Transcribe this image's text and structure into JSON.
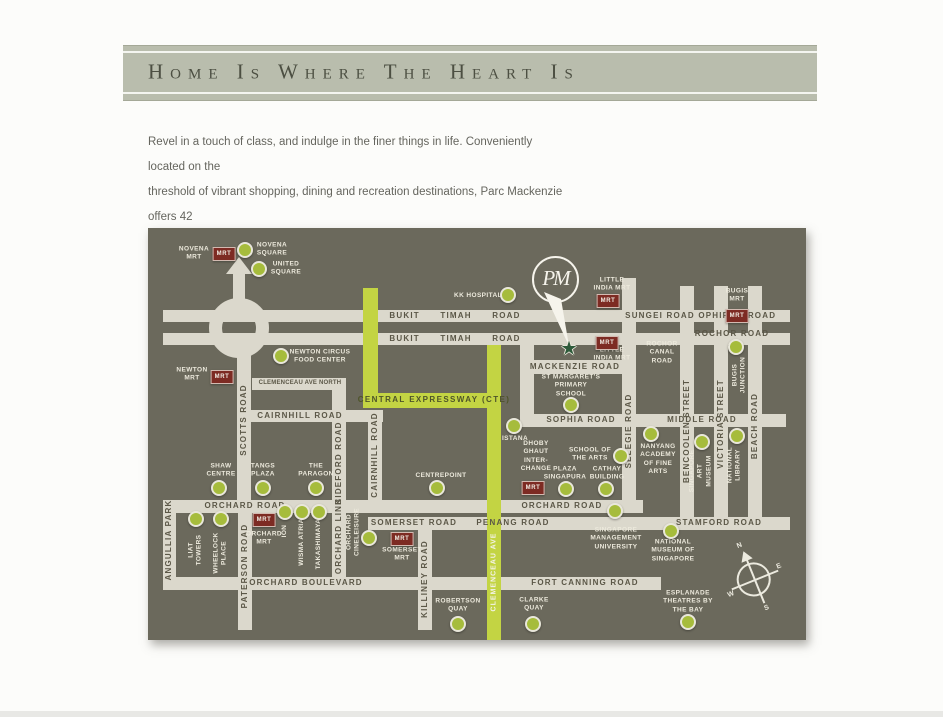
{
  "banner": {
    "title": "Home Is Where The Heart Is"
  },
  "intro": {
    "text": "Revel in a touch of class, and indulge in the finer things in life. Conveniently located on the\nthreshold of vibrant shopping, dining and recreation destinations, Parc Mackenzie offers 42\nunits of freehold contemporary residential living."
  },
  "map": {
    "bg_color": "#6b695c",
    "road_color": "#dbd8cc",
    "expressway_color": "#c3d443",
    "dot_color": "#a6bc3c",
    "mrt_color": "#7d2b23",
    "mrt_label": "MRT",
    "landmark": {
      "monogram": "PM",
      "star_icon": "★"
    },
    "compass": {
      "n": "N",
      "e": "E",
      "s": "S",
      "w": "W"
    },
    "roads": [
      {
        "n": "bukit-timah-sungei-ophir-road",
        "x": 15,
        "y": 82,
        "w": 627,
        "h": 12
      },
      {
        "n": "bukit-timah-rochor-road",
        "x": 15,
        "y": 105,
        "w": 627,
        "h": 12
      },
      {
        "n": "clemenceau-ave-north",
        "x": 104,
        "y": 150,
        "w": 94,
        "h": 12
      },
      {
        "n": "cairnhill-road-h",
        "x": 95,
        "y": 182,
        "w": 140,
        "h": 12
      },
      {
        "n": "mackenzie-west-link",
        "x": 372,
        "y": 117,
        "w": 14,
        "h": 82
      },
      {
        "n": "mackenzie-road",
        "x": 372,
        "y": 132,
        "w": 108,
        "h": 14
      },
      {
        "n": "sophia-middle-road",
        "x": 372,
        "y": 186,
        "w": 266,
        "h": 13
      },
      {
        "n": "selegie-road",
        "x": 474,
        "y": 50,
        "w": 14,
        "h": 222
      },
      {
        "n": "bencoolen-street",
        "x": 532,
        "y": 58,
        "w": 14,
        "h": 231
      },
      {
        "n": "victoria-street",
        "x": 566,
        "y": 58,
        "w": 14,
        "h": 231
      },
      {
        "n": "beach-road",
        "x": 600,
        "y": 58,
        "w": 14,
        "h": 231
      },
      {
        "n": "orchard-road",
        "x": 15,
        "y": 272,
        "w": 480,
        "h": 13
      },
      {
        "n": "somerset-penang-stamford-road",
        "x": 220,
        "y": 289,
        "w": 422,
        "h": 13
      },
      {
        "n": "orchard-blvd-fort-canning-road",
        "x": 15,
        "y": 349,
        "w": 498,
        "h": 13
      },
      {
        "n": "angullia-park",
        "x": 15,
        "y": 285,
        "w": 13,
        "h": 64
      },
      {
        "n": "paterson-road",
        "x": 90,
        "y": 285,
        "w": 14,
        "h": 117
      },
      {
        "n": "scotts-road",
        "x": 89,
        "y": 125,
        "w": 14,
        "h": 147
      },
      {
        "n": "bideford-road",
        "x": 184,
        "y": 162,
        "w": 14,
        "h": 110
      },
      {
        "n": "cairnhill-road-v",
        "x": 220,
        "y": 194,
        "w": 14,
        "h": 78
      },
      {
        "n": "orchard-link",
        "x": 184,
        "y": 285,
        "w": 14,
        "h": 64
      },
      {
        "n": "killiney-road",
        "x": 270,
        "y": 302,
        "w": 14,
        "h": 100
      },
      {
        "n": "central-expressway-vertical",
        "x": 215,
        "y": 60,
        "w": 15,
        "h": 120,
        "c": 1
      },
      {
        "n": "central-expressway-horizontal",
        "x": 215,
        "y": 165,
        "w": 138,
        "h": 15,
        "c": 1
      },
      {
        "n": "clemenceau-ave",
        "x": 339,
        "y": 117,
        "w": 14,
        "h": 295,
        "c": 1
      }
    ],
    "labels": [
      {
        "t": "BUKIT      TIMAH      ROAD",
        "x": 307,
        "y": 88,
        "k": "road"
      },
      {
        "t": "BUKIT      TIMAH      ROAD",
        "x": 307,
        "y": 111,
        "k": "road"
      },
      {
        "t": "SUNGEI ROAD",
        "x": 512,
        "y": 88,
        "k": "road"
      },
      {
        "t": "OPHIR",
        "x": 566,
        "y": 88,
        "k": "road"
      },
      {
        "t": "ROAD",
        "x": 614,
        "y": 88,
        "k": "road"
      },
      {
        "t": "ROCHOR ROAD",
        "x": 584,
        "y": 106,
        "k": "road"
      },
      {
        "t": "CLEMENCEAU AVE NORTH",
        "x": 152,
        "y": 156,
        "k": "roadsm"
      },
      {
        "t": "CAIRNHILL ROAD",
        "x": 152,
        "y": 188,
        "k": "road"
      },
      {
        "t": "MACKENZIE ROAD",
        "x": 427,
        "y": 139,
        "k": "road"
      },
      {
        "t": "SOPHIA ROAD",
        "x": 433,
        "y": 192,
        "k": "road"
      },
      {
        "t": "MIDDLE ROAD",
        "x": 554,
        "y": 192,
        "k": "road"
      },
      {
        "t": "ORCHARD ROAD",
        "x": 97,
        "y": 278,
        "k": "road"
      },
      {
        "t": "ORCHARD ROAD",
        "x": 414,
        "y": 278,
        "k": "road"
      },
      {
        "t": "SOMERSET ROAD",
        "x": 266,
        "y": 295,
        "k": "road"
      },
      {
        "t": "PENANG ROAD",
        "x": 365,
        "y": 295,
        "k": "road"
      },
      {
        "t": "STAMFORD ROAD",
        "x": 571,
        "y": 295,
        "k": "road"
      },
      {
        "t": "ORCHARD BOULEVARD",
        "x": 158,
        "y": 355,
        "k": "road"
      },
      {
        "t": "FORT CANNING ROAD",
        "x": 437,
        "y": 355,
        "k": "road"
      },
      {
        "t": "SCOTTS ROAD",
        "x": 96,
        "y": 192,
        "k": "road",
        "v": 1
      },
      {
        "t": "ANGULLIA PARK",
        "x": 21,
        "y": 312,
        "k": "road",
        "v": 1
      },
      {
        "t": "PATERSON ROAD",
        "x": 97,
        "y": 338,
        "k": "road",
        "v": 1
      },
      {
        "t": "BIDEFORD ROAD",
        "x": 191,
        "y": 235,
        "k": "road",
        "v": 1
      },
      {
        "t": "CAIRNHILL ROAD",
        "x": 227,
        "y": 227,
        "k": "road",
        "v": 1
      },
      {
        "t": "ORCHARD LINK",
        "x": 191,
        "y": 308,
        "k": "road",
        "v": 1
      },
      {
        "t": "KILLINEY ROAD",
        "x": 277,
        "y": 351,
        "k": "road",
        "v": 1
      },
      {
        "t": "SELEGIE ROAD",
        "x": 481,
        "y": 203,
        "k": "road",
        "v": 1
      },
      {
        "t": "BENCOOLEN STREET",
        "x": 539,
        "y": 203,
        "k": "road",
        "v": 1
      },
      {
        "t": "VICTORIA STREET",
        "x": 573,
        "y": 196,
        "k": "road",
        "v": 1
      },
      {
        "t": "BEACH ROAD",
        "x": 607,
        "y": 198,
        "k": "road",
        "v": 1
      },
      {
        "t": "CENTRAL EXPRESSWAY (CTE)",
        "x": 286,
        "y": 172,
        "k": "lime"
      },
      {
        "t": "CLEMENCEAU AVE",
        "x": 346,
        "y": 344,
        "k": "limew",
        "v": 1
      },
      {
        "t": "NOVENA\nMRT",
        "x": 46,
        "y": 26,
        "k": "poi"
      },
      {
        "t": "NOVENA\nSQUARE",
        "x": 124,
        "y": 22,
        "k": "poi"
      },
      {
        "t": "UNITED\nSQUARE",
        "x": 138,
        "y": 41,
        "k": "poi"
      },
      {
        "t": "NEWTON\nMRT",
        "x": 44,
        "y": 147,
        "k": "poi"
      },
      {
        "t": "NEWTON CIRCUS\nFOOD CENTER",
        "x": 172,
        "y": 129,
        "k": "poi"
      },
      {
        "t": "KK HOSPITAL",
        "x": 330,
        "y": 68,
        "k": "poi"
      },
      {
        "t": "LITTLE\nINDIA MRT",
        "x": 464,
        "y": 57,
        "k": "poi"
      },
      {
        "t": "LITTLE\nINDIA MRT",
        "x": 464,
        "y": 127,
        "k": "poi"
      },
      {
        "t": "BUGIS\nMRT",
        "x": 589,
        "y": 68,
        "k": "poi"
      },
      {
        "t": "ROCHOR\nCANAL\nROAD",
        "x": 514,
        "y": 125,
        "k": "poi"
      },
      {
        "t": "ST MARGARET'S\nPRIMARY\nSCHOOL",
        "x": 423,
        "y": 158,
        "k": "poi"
      },
      {
        "t": "ISTANA",
        "x": 367,
        "y": 211,
        "k": "poi"
      },
      {
        "t": "DHOBY\nGHAUT\nINTER-\nCHANGE",
        "x": 388,
        "y": 229,
        "k": "poi"
      },
      {
        "t": "SCHOOL OF\nTHE ARTS",
        "x": 442,
        "y": 227,
        "k": "poi"
      },
      {
        "t": "NANYANG\nACADEMY\nOF FINE\nARTS",
        "x": 510,
        "y": 232,
        "k": "poi"
      },
      {
        "t": "PLAZA\nSINGAPURA",
        "x": 417,
        "y": 246,
        "k": "poi"
      },
      {
        "t": "CATHAY\nBUILDING",
        "x": 459,
        "y": 246,
        "k": "poi"
      },
      {
        "t": "SHAW\nCENTRE",
        "x": 73,
        "y": 243,
        "k": "poi"
      },
      {
        "t": "TANGS\nPLAZA",
        "x": 115,
        "y": 243,
        "k": "poi"
      },
      {
        "t": "THE\nPARAGON",
        "x": 168,
        "y": 243,
        "k": "poi"
      },
      {
        "t": "CENTREPOINT",
        "x": 293,
        "y": 248,
        "k": "poi"
      },
      {
        "t": "ORCHARD\nMRT",
        "x": 116,
        "y": 311,
        "k": "poi"
      },
      {
        "t": "SOMERSET\nMRT",
        "x": 254,
        "y": 327,
        "k": "poi"
      },
      {
        "t": "SINGAPORE\nMANAGEMENT\nUNIVERSITY",
        "x": 468,
        "y": 311,
        "k": "poi"
      },
      {
        "t": "NATIONAL\nMUSEUM OF\nSINGAPORE",
        "x": 525,
        "y": 323,
        "k": "poi"
      },
      {
        "t": "ROBERTSON\nQUAY",
        "x": 310,
        "y": 378,
        "k": "poi"
      },
      {
        "t": "CLARKE\nQUAY",
        "x": 386,
        "y": 377,
        "k": "poi"
      },
      {
        "t": "ESPLANADE\nTHEATRES BY\nTHE BAY",
        "x": 540,
        "y": 374,
        "k": "poi"
      },
      {
        "t": "LIAT\nTOWERS",
        "x": 48,
        "y": 322,
        "k": "poi",
        "v": 1
      },
      {
        "t": "WHEELOCK\nPLACE",
        "x": 73,
        "y": 325,
        "k": "poi",
        "v": 1
      },
      {
        "t": "ION",
        "x": 137,
        "y": 303,
        "k": "poi",
        "v": 1
      },
      {
        "t": "WISMA ATRIA",
        "x": 154,
        "y": 314,
        "k": "poi",
        "v": 1
      },
      {
        "t": "TAKASHIMAYA",
        "x": 171,
        "y": 316,
        "k": "poi",
        "v": 1
      },
      {
        "t": "ORCHARD\nCINELEISURE",
        "x": 206,
        "y": 304,
        "k": "poi",
        "v": 1
      },
      {
        "t": "BUGIS\nJUNCTION",
        "x": 592,
        "y": 147,
        "k": "poi",
        "v": 1
      },
      {
        "t": "SINGAPORE\nART\nMUSEUM",
        "x": 553,
        "y": 243,
        "k": "poi",
        "v": 1
      },
      {
        "t": "NATIONAL\nLIBRARY",
        "x": 587,
        "y": 237,
        "k": "poi",
        "v": 1
      }
    ],
    "dots": [
      {
        "n": "novena-square",
        "x": 97,
        "y": 22
      },
      {
        "n": "united-square",
        "x": 111,
        "y": 41
      },
      {
        "n": "newton-circus-food-center",
        "x": 133,
        "y": 128
      },
      {
        "n": "kk-hospital",
        "x": 360,
        "y": 67
      },
      {
        "n": "shaw-centre",
        "x": 71,
        "y": 260
      },
      {
        "n": "tangs-plaza",
        "x": 115,
        "y": 260
      },
      {
        "n": "the-paragon",
        "x": 168,
        "y": 260
      },
      {
        "n": "liat-towers",
        "x": 48,
        "y": 291
      },
      {
        "n": "wheelock-place",
        "x": 73,
        "y": 291
      },
      {
        "n": "ion",
        "x": 137,
        "y": 284
      },
      {
        "n": "wisma-atria",
        "x": 154,
        "y": 284
      },
      {
        "n": "takashimaya",
        "x": 171,
        "y": 284
      },
      {
        "n": "orchard-cineleisure",
        "x": 221,
        "y": 310
      },
      {
        "n": "centrepoint",
        "x": 289,
        "y": 260
      },
      {
        "n": "istana",
        "x": 366,
        "y": 198
      },
      {
        "n": "st-margarets-primary-school",
        "x": 423,
        "y": 177
      },
      {
        "n": "plaza-singapura",
        "x": 418,
        "y": 261
      },
      {
        "n": "cathay-building",
        "x": 458,
        "y": 261
      },
      {
        "n": "school-of-the-arts",
        "x": 473,
        "y": 228
      },
      {
        "n": "nanyang-academy-of-fine-arts",
        "x": 503,
        "y": 206
      },
      {
        "n": "singapore-art-museum",
        "x": 554,
        "y": 214
      },
      {
        "n": "national-library",
        "x": 589,
        "y": 208
      },
      {
        "n": "bugis-junction",
        "x": 588,
        "y": 119
      },
      {
        "n": "singapore-management-university",
        "x": 467,
        "y": 283
      },
      {
        "n": "national-museum-of-singapore",
        "x": 523,
        "y": 303
      },
      {
        "n": "robertson-quay",
        "x": 310,
        "y": 396
      },
      {
        "n": "clarke-quay",
        "x": 385,
        "y": 396
      },
      {
        "n": "esplanade-theatres-by-the-bay",
        "x": 540,
        "y": 394
      }
    ],
    "mrt_badges": [
      {
        "n": "novena",
        "x": 76,
        "y": 26
      },
      {
        "n": "newton",
        "x": 74,
        "y": 149
      },
      {
        "n": "little-india-top",
        "x": 460,
        "y": 73
      },
      {
        "n": "little-india-bottom",
        "x": 459,
        "y": 115
      },
      {
        "n": "bugis",
        "x": 589,
        "y": 88
      },
      {
        "n": "dhoby-ghaut",
        "x": 385,
        "y": 260
      },
      {
        "n": "orchard",
        "x": 116,
        "y": 292
      },
      {
        "n": "somerset",
        "x": 254,
        "y": 311
      }
    ]
  }
}
